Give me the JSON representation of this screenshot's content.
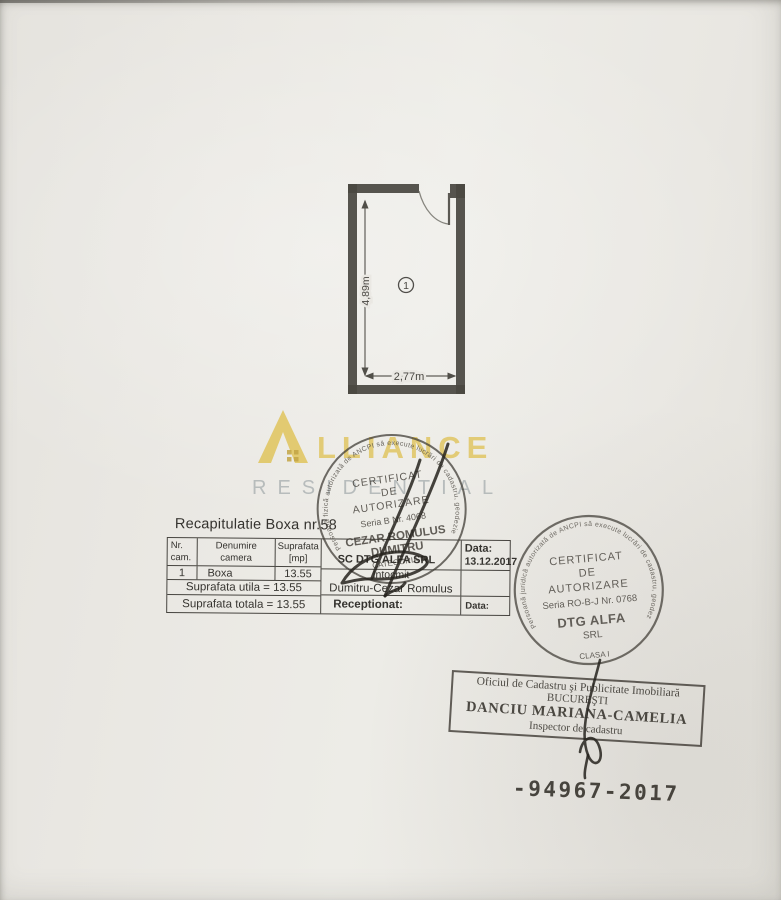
{
  "watermark": {
    "brand_rest": "LLIANCE",
    "subtitle": "RESIDENTIAL",
    "gold": "#debd4a",
    "gray": "#a8aeb0"
  },
  "floor_plan": {
    "room_number": "1",
    "height_dimension": "4,89m",
    "width_dimension": "2,77m"
  },
  "recap": {
    "title": "Recapitulatie Boxa nr.58",
    "headers": {
      "nr_cam": "Nr.\ncam.",
      "denumire": "Denumire\ncamera",
      "suprafata": "Suprafata\n[mp]"
    },
    "row1": {
      "nr": "1",
      "denumire": "Boxa",
      "suprafata": "13.55"
    },
    "suprafata_utila": "Suprafata utila = 13.55",
    "suprafata_totala": "Suprafata totala = 13.55",
    "company": "SC DTG ALFA SRL",
    "date_label": "Data:",
    "date_value": "13.12.2017",
    "intocmit_label": "Intocmit",
    "intocmit_name": "Dumitru-Cezar Romulus",
    "receptionat_label": "Receptionat:",
    "date_label2": "Data:"
  },
  "stamp_person": {
    "ring_text": "Persoană fizică autorizată de ANCPI să execute lucrări de cadastru, geodezie şi cartografie",
    "title1": "CERTIFICAT",
    "title2": "DE",
    "title3": "AUTORIZARE",
    "serial": "Seria B Nr. 4068",
    "name_line1": "CEZAR ROMULUS",
    "name_line2": "DUMITRU",
    "category": "CATEGORIA D"
  },
  "stamp_company": {
    "ring_text": "Persoană juridică autorizată de ANCPI să execute lucrări de cadastru, geodezie şi cartografie",
    "title1": "CERTIFICAT",
    "title2": "DE",
    "title3": "AUTORIZARE",
    "serial": "Seria RO-B-J Nr. 0768",
    "name_line1": "DTG ALFA",
    "name_line2": "SRL",
    "class_label": "CLASA I"
  },
  "office_stamp": {
    "line1": "Oficiul de Cadastru şi Publicitate Imobiliară",
    "line2": "BUCUREŞTI",
    "line3": "DANCIU MARIANA-CAMELIA",
    "line4": "Inspector de cadastru"
  },
  "registration_number": "-94967-2017"
}
